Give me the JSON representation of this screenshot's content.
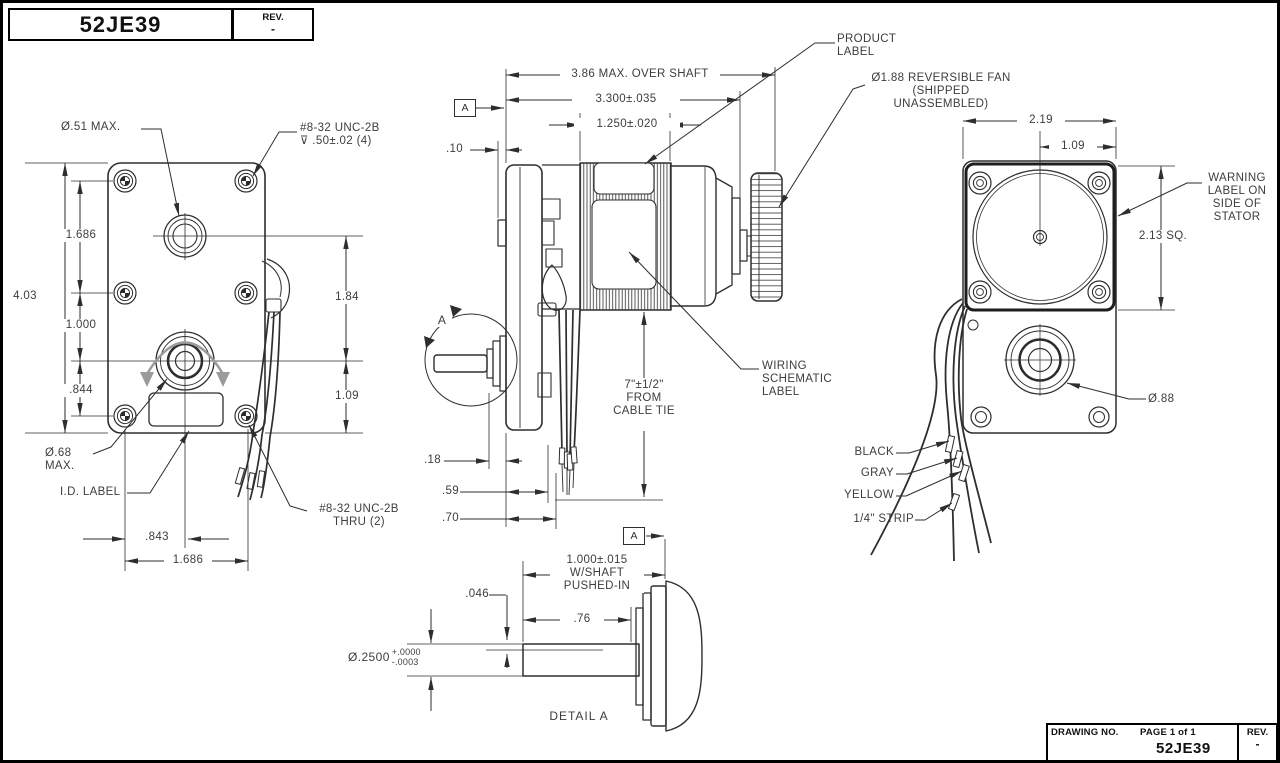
{
  "title_block_top": {
    "number": "52JE39",
    "rev_label": "REV.",
    "rev_value": "-"
  },
  "title_block_bottom": {
    "drawing_no_label": "DRAWING NO.",
    "page_label": "PAGE 1 of 1",
    "number": "52JE39",
    "rev_label": "REV.",
    "rev_value": "-"
  },
  "front_view": {
    "dim_height": "4.03",
    "dim_screw_span_v": "1.686",
    "dim_screw_to_shaft": "1.000",
    "dim_shaft_to_screw": ".844",
    "dim_hole_to_shaft": "1.84",
    "dim_shaft_to_bottom": "1.09",
    "dim_screw_to_center": ".843",
    "dim_screw_span_h": "1.686",
    "label_hole": "Ø.51 MAX.",
    "label_tapped_holes": "#8-32 UNC-2B\n⊽ .50±.02 (4)",
    "label_hub": "Ø.68\nMAX.",
    "label_id": "I.D. LABEL",
    "label_thru_holes": "#8-32 UNC-2B\nTHRU (2)"
  },
  "side_view": {
    "dim_over_shaft": "3.86 MAX. OVER SHAFT",
    "dim_body": "3.300±.035",
    "dim_stator": "1.250±.020",
    "dim_plate": ".10",
    "dim_hub": ".18",
    "dim_tie1": ".59",
    "dim_tie2": ".70",
    "label_product": "PRODUCT\nLABEL",
    "label_fan": "Ø1.88 REVERSIBLE FAN\n(SHIPPED UNASSEMBLED)",
    "label_wiring": "WIRING\nSCHEMATIC\nLABEL",
    "label_cable_tie": "7\"±1/2\"\nFROM\nCABLE TIE",
    "datum": "A",
    "detail_marker": "A"
  },
  "rear_view": {
    "dim_width": "2.19",
    "dim_center": "1.09",
    "dim_square": "2.13 SQ.",
    "dim_hub": "Ø.88",
    "label_warning": "WARNING\nLABEL ON\nSIDE OF\nSTATOR",
    "wire_labels": {
      "black": "BLACK",
      "gray": "GRAY",
      "yellow": "YELLOW",
      "strip": "1/4\" STRIP"
    }
  },
  "detail_view": {
    "datum": "A",
    "dim_length": "1.000±.015\nW/SHAFT\nPUSHED-IN",
    "dim_exposed": ".76",
    "dim_step": ".046",
    "dim_shaft_dia": "Ø.2500",
    "tol_plus": "+.0000",
    "tol_minus": "-.0003",
    "title": "DETAIL A"
  }
}
